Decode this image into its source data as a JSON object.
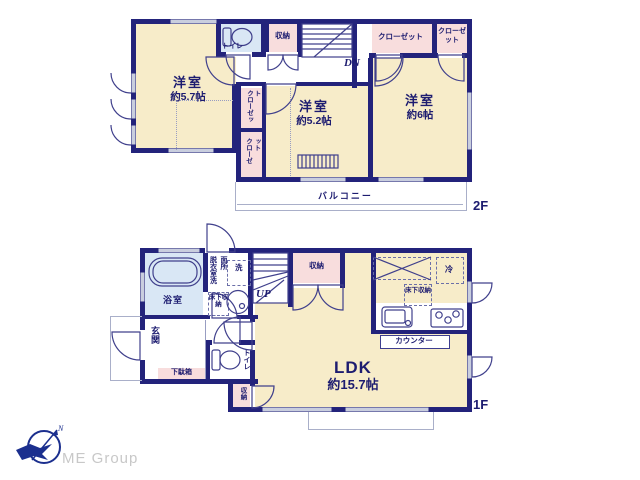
{
  "plan": {
    "floor2": {
      "floor_label": "2F",
      "room_57_name": "洋室",
      "room_57_size": "約5.7帖",
      "room_52_name": "洋室",
      "room_52_size": "約5.2帖",
      "room_6_name": "洋室",
      "room_6_size": "約6帖",
      "toilet": "トイレ",
      "storage": "収納",
      "closet_top_wide": "クローゼット",
      "closet_top_small": "クローゼット",
      "closet_mid": "クローゼット",
      "closet_low": "クローゼット",
      "stairs_down": "DN",
      "balcony": "バルコニー"
    },
    "floor1": {
      "floor_label": "1F",
      "bath": "浴室",
      "dressing_washroom": "脱衣室洗面所",
      "washer": "洗",
      "underfloor_storage_wash": "床下収納",
      "entrance": "玄関",
      "shoe_cabinet": "下駄箱",
      "toilet": "トイレ",
      "storage_hall": "収納",
      "storage_small": "収納",
      "stairs_up": "UP",
      "ldk_name": "LDK",
      "ldk_size": "約15.7帖",
      "counter": "カウンター",
      "fridge": "冷",
      "underfloor_storage_kitchen": "床下収納"
    },
    "logo": {
      "company": "ME Group"
    },
    "colors": {
      "wall": "#23237b",
      "room_cream": "#f7ecc9",
      "closet_pink": "#f8dddd",
      "wet_blue": "#d9e7f5",
      "outline_light": "#a9afc9",
      "logo_navy": "#1b2f8e"
    }
  }
}
